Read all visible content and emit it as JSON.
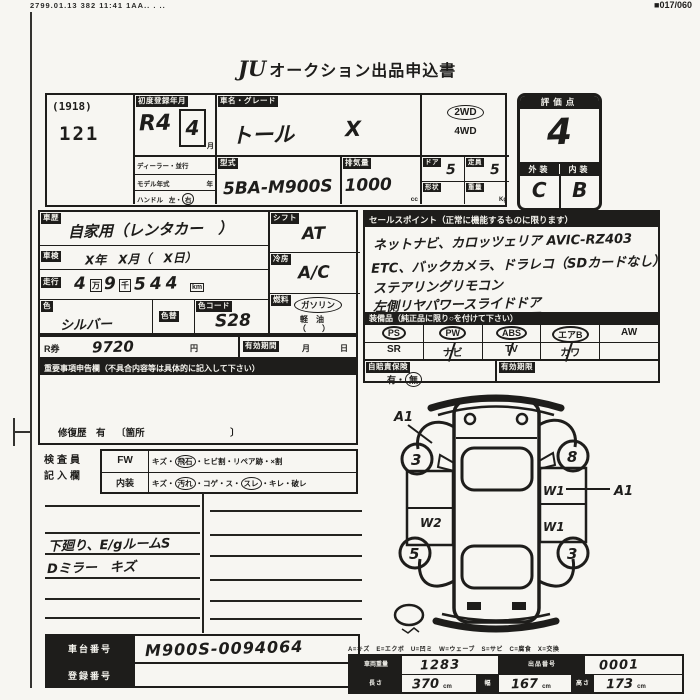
{
  "fax": {
    "left": "2799.01.13 382 11:41 1AA.. . ..",
    "icon": "■",
    "right": "017/060"
  },
  "title": {
    "logo": "JU",
    "text": "オークション出品申込書"
  },
  "lot": {
    "code": "(1918)",
    "number": "121"
  },
  "regdate": {
    "label": "初度登録年月",
    "era": "R4",
    "month": "4",
    "month_suffix": "月"
  },
  "carname": {
    "label": "車名・グレード",
    "name": "トール",
    "grade": "X"
  },
  "drive": {
    "opt1": "2WD",
    "opt2": "4WD"
  },
  "score": {
    "label": "評価点",
    "value": "4",
    "ext_label": "外装",
    "int_label": "内装",
    "ext": "C",
    "int": "B"
  },
  "meta": {
    "dealer": "ディーラー・並行",
    "model_year": "モデル年式",
    "year_unit": "年",
    "handle": "ハンドル",
    "left": "左",
    "sep": "・",
    "right": "右",
    "model_label": "型式",
    "model_value": "5BA-M900S",
    "disp_label": "排気量",
    "disp_value": "1000",
    "disp_unit": "cc",
    "door_label": "ドア",
    "door": "5",
    "cap_label": "定員",
    "cap": "5",
    "shape_label": "形状",
    "weight_label": "重量",
    "weight_unit": "Kg"
  },
  "usage": {
    "label": "車歴",
    "value": "自家用（レンタカー　）"
  },
  "shaken": {
    "label": "車検",
    "value": "X年　X月（　X日）"
  },
  "mileage": {
    "label": "走行",
    "d1": "4",
    "u1": "万",
    "d2": "9",
    "u2": "千",
    "d3": "544",
    "unit": "km"
  },
  "color": {
    "label": "色",
    "value": "シルバー",
    "change_label": "色替",
    "code_label": "色コード",
    "code": "S28"
  },
  "shift": {
    "label": "シフト",
    "value": "AT"
  },
  "ac": {
    "label": "冷房",
    "value": "A/C"
  },
  "fuel": {
    "label": "燃料",
    "gas": "ガソリン",
    "diesel": "軽　油",
    "other": "（　　）"
  },
  "recycle": {
    "label": "R券",
    "value": "9720",
    "yen": "円",
    "term_label": "有効期間",
    "month": "月",
    "day": "日"
  },
  "notice": {
    "header": "重要事項申告欄（不具合内容等は具体的に記入して下さい）",
    "footer_pre": "修復歴　有",
    "footer_bracket": "〔箇所　　　　　　　　　〕"
  },
  "inspector": {
    "label1": "検査員",
    "label2": "記入欄",
    "fw_label": "FW",
    "fw": [
      "キズ・",
      "飛石",
      "・ヒビ割・リペア跡・×割"
    ],
    "int_label": "内装",
    "interior": [
      "キズ・",
      "汚れ",
      "・コゲ・ス・",
      "スレ",
      "・キレ・破レ"
    ]
  },
  "memo": {
    "line1": "下廻り、E/gルームS",
    "line2": "Dミラー　キズ"
  },
  "sales": {
    "header": "セールスポイント（正常に機能するものに限ります）",
    "lines": [
      "ネットナビ、カロッツェリア AVIC-RZ403",
      "ETC、バックカメラ、ドラレコ（SDカードなし）",
      "ステアリングリモコン",
      "左側リヤパワースライドドア"
    ]
  },
  "equipment": {
    "header": "装備品（純正品に限り○を付けて下さい）",
    "row1": [
      "PS",
      "PW",
      "ABS",
      "エアB",
      "AW"
    ],
    "row2": [
      "SR",
      "ナビ",
      "TV",
      "カワ",
      ""
    ]
  },
  "insurance": {
    "label": "自賠責保険",
    "yes": "有",
    "sep": "・",
    "no": "無",
    "term_label": "有効期限"
  },
  "diagram": {
    "a1_top": "A1",
    "w1_top": "W1",
    "a1_right": "A1",
    "w1_bottom": "W1",
    "w2": "W2",
    "wheel_fl": "3",
    "wheel_fr": "8",
    "wheel_rl": "5",
    "wheel_rr": "3"
  },
  "chassis": {
    "label": "車台番号",
    "value": "M900S-0094064"
  },
  "regno": {
    "label": "登録番号",
    "value": ""
  },
  "measure": {
    "legend": "A=キズ　E=エクボ　U=凹ミ　W=ウェーブ　S=サビ　C=腐食　X=交換",
    "r1c1_label": "車両重量",
    "r1c1": "1283",
    "r1c2_label": "出品番号",
    "r1c2": "0001",
    "r2c1_label": "長さ",
    "r2c1": "370",
    "r2c2_label": "幅",
    "r2c2": "167",
    "r2c3_label": "高さ",
    "r2c3": "173",
    "unit": "cm"
  }
}
